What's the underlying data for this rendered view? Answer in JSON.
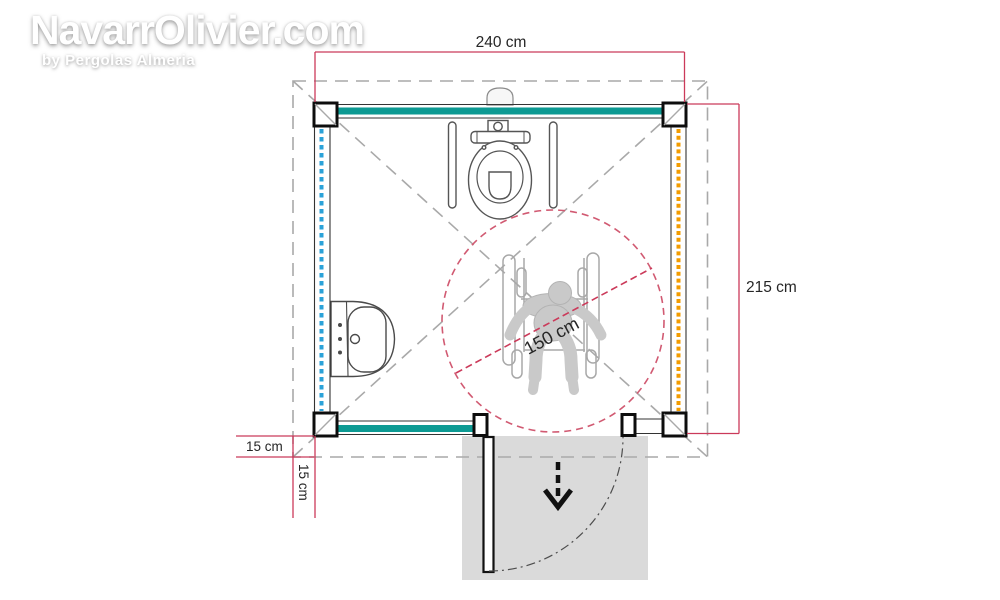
{
  "watermark": {
    "title": "NavarrOlivier.com",
    "subtitle": "by Pergolas Almeria"
  },
  "dimensions": {
    "width_label": "240 cm",
    "height_label": "215 cm",
    "overhang_vertical_label": "15 cm",
    "overhang_horizontal_label": "15 cm",
    "turning_circle_label": "150 cm"
  },
  "colors": {
    "dimension_red": "#CB3A5A",
    "turning_circle_pink": "#D15A72",
    "wall_teal": "#0D9A93",
    "insulation_blue": "#2BA2D8",
    "insulation_orange": "#F39C00",
    "roof_dash_gray": "#A9A9A9",
    "figure_gray": "#C9C9C9",
    "door_area_gray": "#DADADA"
  }
}
